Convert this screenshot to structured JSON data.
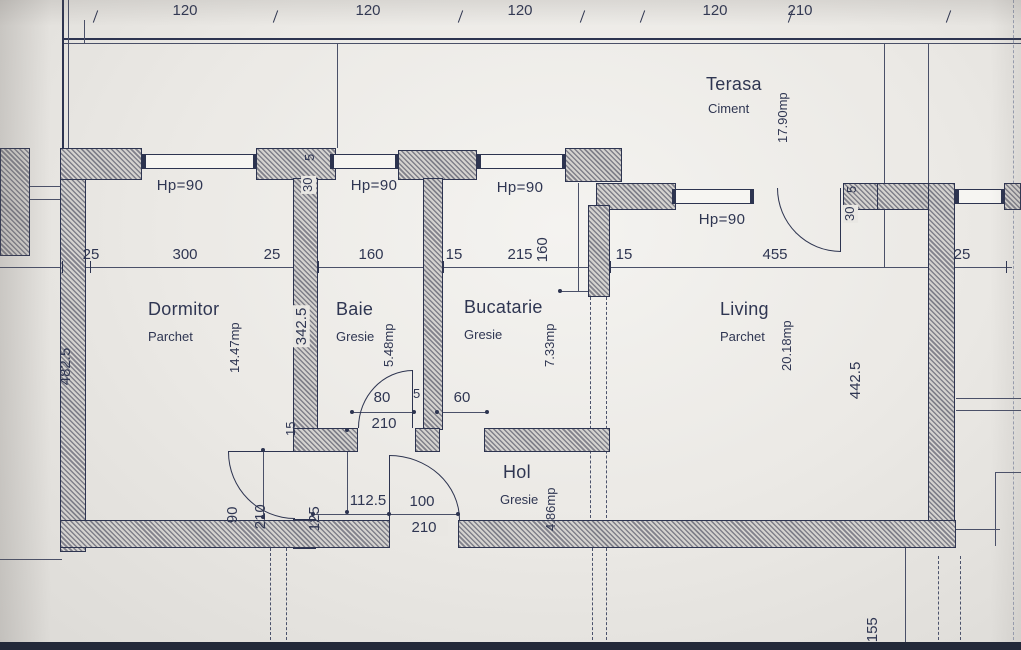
{
  "top_dims": [
    "120",
    "120",
    "120",
    "120",
    "210"
  ],
  "dim_row": [
    "25",
    "300",
    "25",
    "160",
    "15",
    "215",
    "15",
    "455",
    "25"
  ],
  "hp_labels": [
    "Hp=90",
    "Hp=90",
    "Hp=90",
    "Hp=90"
  ],
  "vertical_dims": {
    "left_wall": "482.5",
    "dormitor_baie_wall": "342.5",
    "bucatarie_window": "160",
    "living_right": "442.5",
    "below_plan": "155",
    "parapet_30_left": "30",
    "parapet_5_left": "5",
    "parapet_30_right": "30",
    "parapet_5_right": "5",
    "dormitor_door_width": "90",
    "dormitor_door_height": "210",
    "hol_wall": "125",
    "wall_thickness": "15"
  },
  "door_dims": {
    "baie_door_width": "80",
    "baie_door_height": "210",
    "pier": "5",
    "bucatarie_opening": "60",
    "hol_left": "112.5",
    "entry_door_width": "100",
    "entry_door_height": "210"
  },
  "rooms": {
    "terasa": {
      "name": "Terasa",
      "finish": "Ciment",
      "area": "17.90mp"
    },
    "dormitor": {
      "name": "Dormitor",
      "finish": "Parchet",
      "area": "14.47mp"
    },
    "baie": {
      "name": "Baie",
      "finish": "Gresie",
      "area": "5.48mp"
    },
    "bucatarie": {
      "name": "Bucatarie",
      "finish": "Gresie",
      "area": "7.33mp"
    },
    "living": {
      "name": "Living",
      "finish": "Parchet",
      "area": "20.18mp"
    },
    "hol": {
      "name": "Hol",
      "finish": "Gresie",
      "area": "4.86mp"
    }
  },
  "colors": {
    "ink": "#2d3450",
    "paper": "#ebe9e5",
    "hatch_gray": "#80808a"
  }
}
